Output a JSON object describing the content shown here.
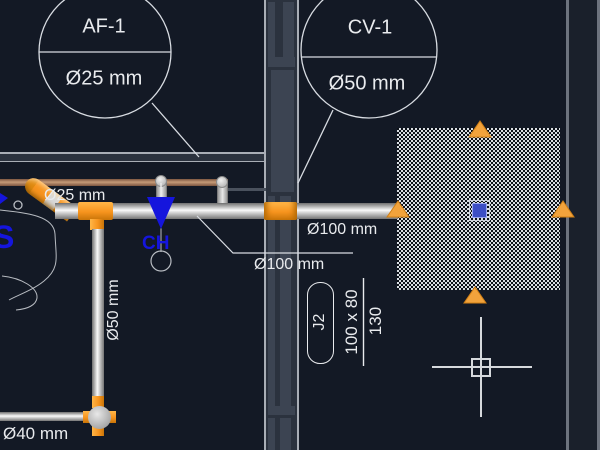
{
  "drawing": {
    "type": "cad-piping-plan",
    "colors": {
      "background": "#131925",
      "pipe_orange": "#f7941e",
      "valve_blue": "#1515dd",
      "annotation_text": "#e9ebee",
      "grip_orange": "#f2a33c",
      "grip_selected_blue": "#3c4ec5",
      "hatch_light": "#d9dde2",
      "tan_pipe": "#c59a77"
    },
    "callouts": {
      "af1": {
        "tag": "AF-1",
        "size": "Ø25 mm"
      },
      "cv1": {
        "tag": "CV-1",
        "size": "Ø50 mm"
      }
    },
    "pipe_labels": {
      "branch_25": "Ø25 mm",
      "main_100_upper": "Ø100 mm",
      "main_100_lower": "Ø100 mm",
      "riser_50": "Ø50 mm",
      "drain_40": "Ø40 mm"
    },
    "valve_label": "CH",
    "fixture_label": "S",
    "junction_box": {
      "tag": "J2",
      "dimensions": "100 x 80",
      "depth": "130"
    }
  }
}
